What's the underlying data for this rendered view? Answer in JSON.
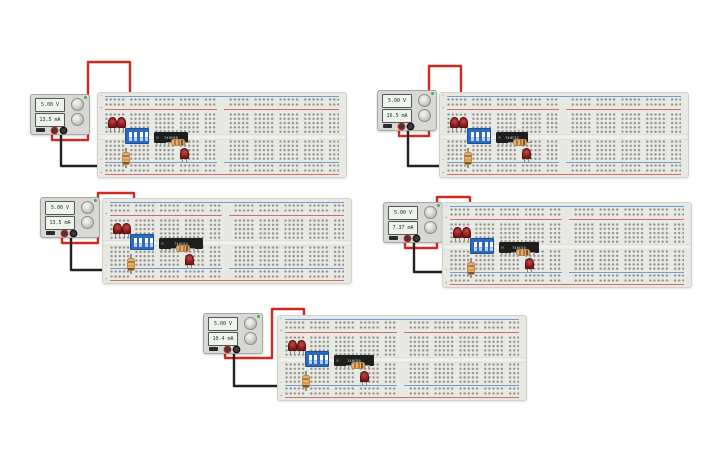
{
  "canvas": {
    "width": 725,
    "height": 453,
    "background": "#ffffff"
  },
  "colors": {
    "wire_red": "#cf2a1f",
    "wire_black": "#222222",
    "wire_green": "#47a647",
    "board_body": "#e9e9e4",
    "rail_red_line": "#cc4341",
    "rail_blue_line": "#4a7fd0",
    "led_red": "#8c1d1d",
    "dip_blue": "#2a6bc0",
    "ic_black": "#1e1e1e",
    "psu_body": "#d8d8d5",
    "display_bg": "#eef3ec",
    "power_indicator_green": "#3fae4a"
  },
  "breadboard_labels": {
    "rail_positive": "+",
    "rail_negative": "−"
  },
  "components_per_circuit": {
    "power_supply": 1,
    "breadboard": 1,
    "red_leds": 3,
    "resistors": 2,
    "dip_switch_positions": 4,
    "logic_ic": 1,
    "red_supply_wire": 1,
    "black_ground_wire": 1,
    "green_jumpers": 3
  },
  "circuits": [
    {
      "name": "circuit-1",
      "position": "top-left",
      "power_supply": {
        "voltage": "5.00 V",
        "current": "13.5 mA"
      },
      "ic_label": "74HC08"
    },
    {
      "name": "circuit-2",
      "position": "top-right",
      "power_supply": {
        "voltage": "5.00 V",
        "current": "16.5 mA"
      },
      "ic_label": "74HC32"
    },
    {
      "name": "circuit-3",
      "position": "middle-left",
      "power_supply": {
        "voltage": "5.00 V",
        "current": "13.5 mA"
      },
      "ic_label": "74HC04"
    },
    {
      "name": "circuit-4",
      "position": "middle-right",
      "power_supply": {
        "voltage": "5.00 V",
        "current": "7.37 mA"
      },
      "ic_label": "74HC00"
    },
    {
      "name": "circuit-5",
      "position": "bottom-center",
      "power_supply": {
        "voltage": "5.00 V",
        "current": "10.4 mA"
      },
      "ic_label": "74HC86"
    }
  ]
}
